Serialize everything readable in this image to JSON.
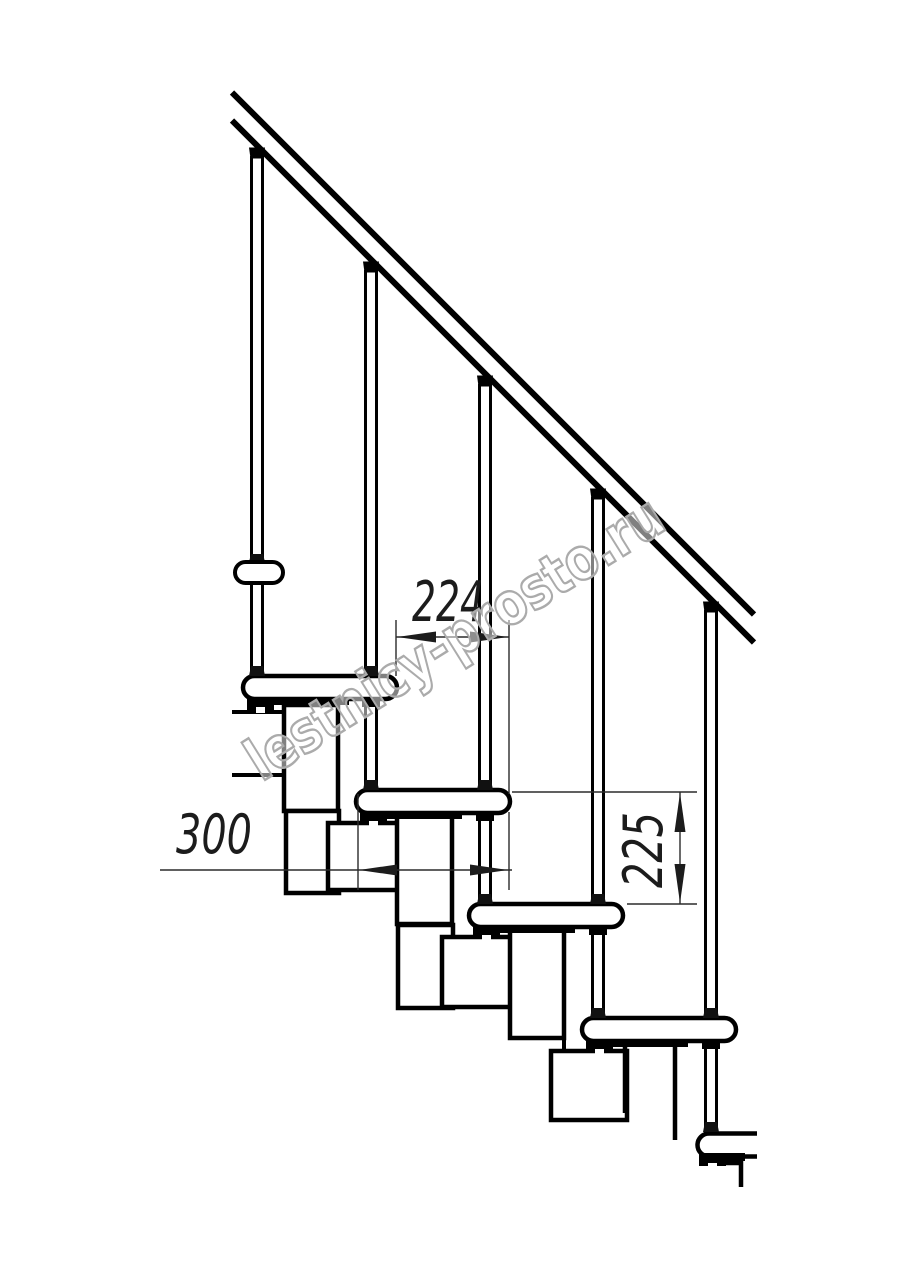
{
  "drawing": {
    "background": "#ffffff",
    "line_color": "#000000",
    "dimension_color": "#2b2b2b",
    "dimensions": {
      "run_horizontal": "224",
      "tread_length": "300",
      "rise_vertical": "225"
    },
    "watermark": {
      "text": "lestnicy-prosto.ru",
      "color": "#ababab"
    }
  }
}
